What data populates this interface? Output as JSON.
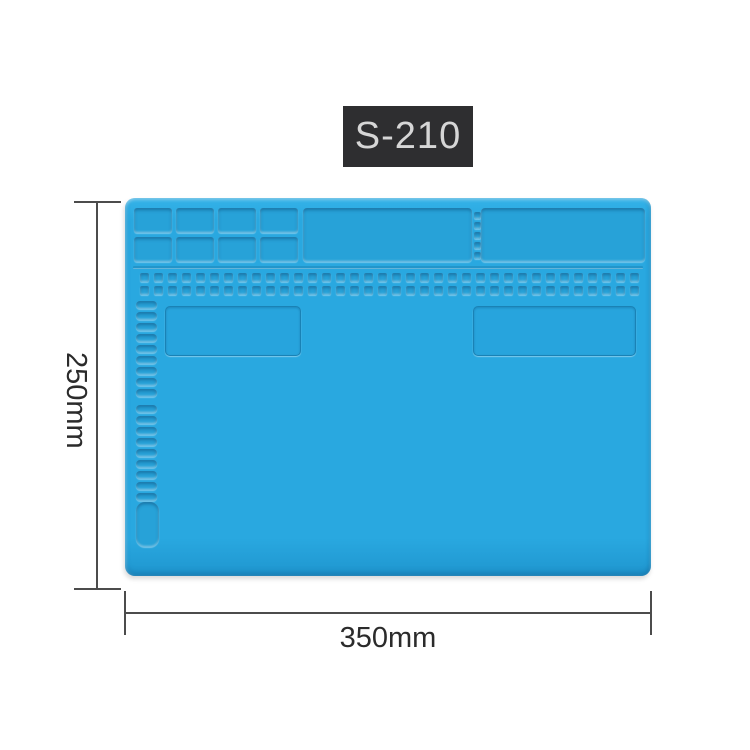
{
  "product_badge": {
    "label": "S-210",
    "background": "#2e2e30",
    "text_color": "#d6d6d6"
  },
  "mat": {
    "description": "blue silicone soldering repair mat",
    "base_color": "#29a8e0",
    "recess_color": "#27a2d8",
    "small_cell_count": 8,
    "divider_notch_count": 5,
    "tiny_squares_per_row": 36,
    "pill_group_1_count": 9,
    "pill_group_2_count": 9
  },
  "dimension_annotations": {
    "height_label": "250mm",
    "width_label": "350mm",
    "line_color": "#4c4c4c",
    "text_color": "#2b2b2b"
  }
}
